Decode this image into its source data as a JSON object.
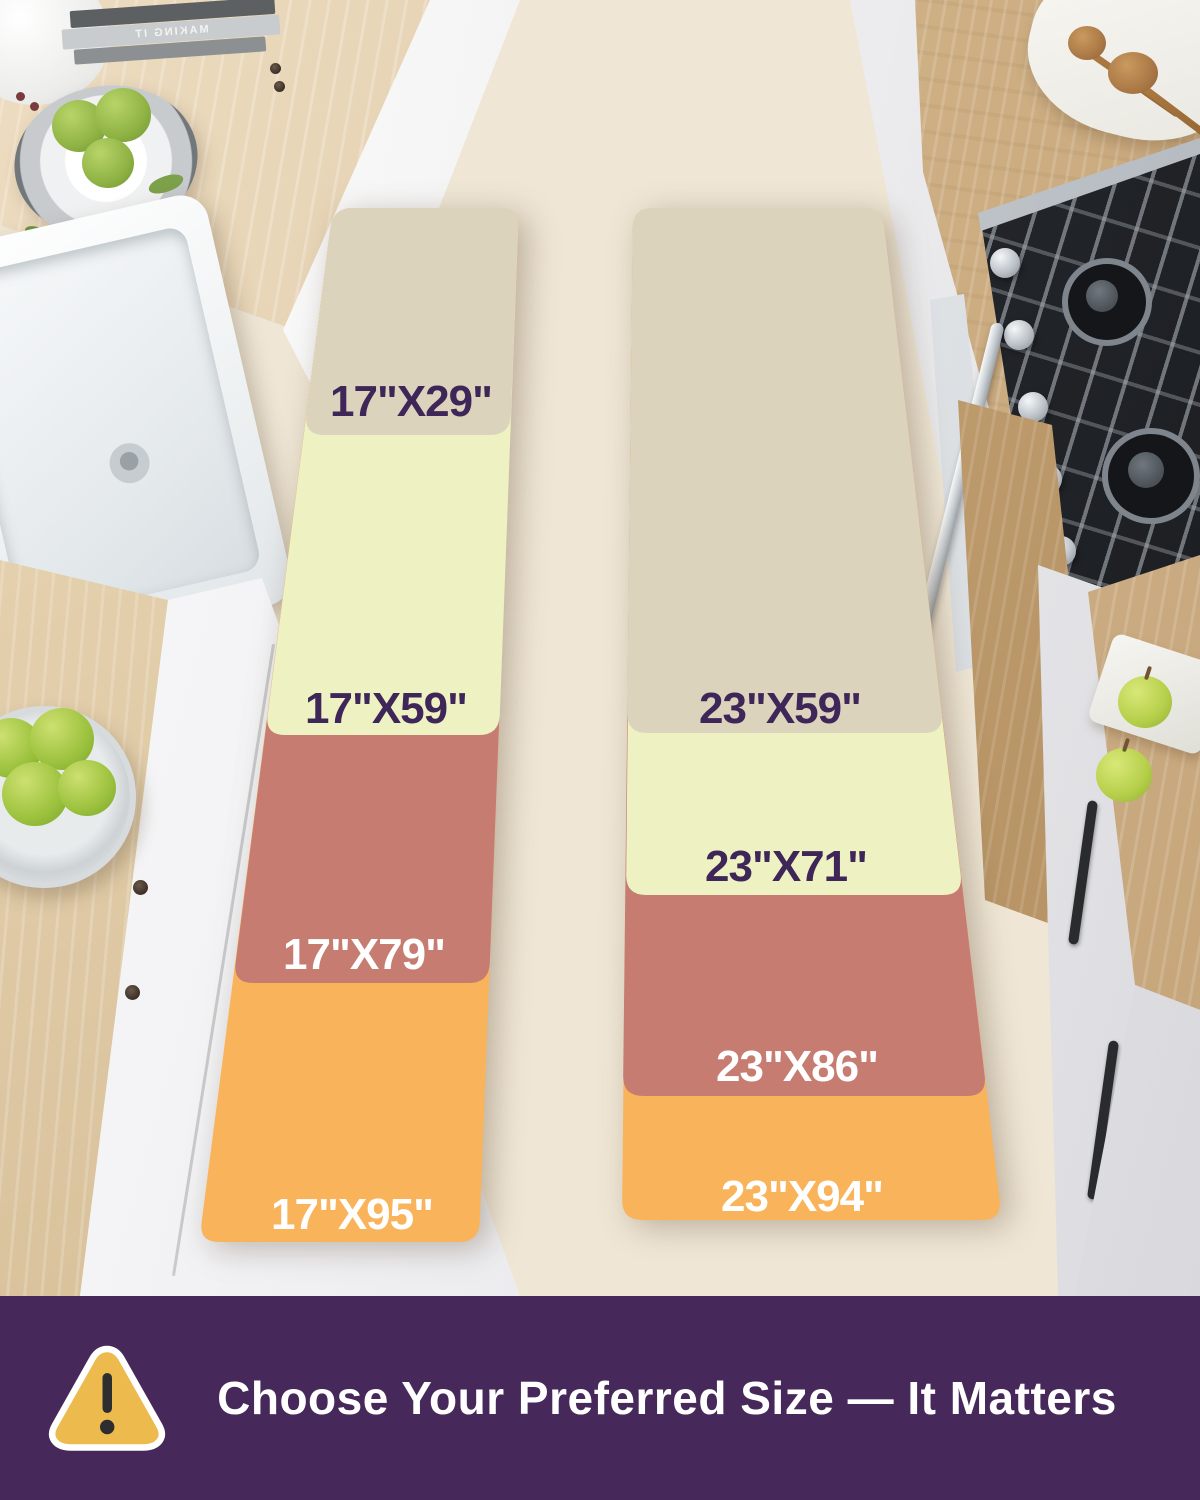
{
  "runners": {
    "left": {
      "name": "17-inch wide runner",
      "sizes": [
        {
          "label": "17\"X29\"",
          "color": "#dcd3bc",
          "label_color": "#3f2659"
        },
        {
          "label": "17\"X59\"",
          "color": "#eef2c3",
          "label_color": "#3f2659"
        },
        {
          "label": "17\"X79\"",
          "color": "#c67c71",
          "label_color": "#ffffff"
        },
        {
          "label": "17\"X95\"",
          "color": "#f9b45b",
          "label_color": "#ffffff"
        }
      ]
    },
    "right": {
      "name": "23-inch wide runner",
      "sizes": [
        {
          "label": "23\"X59\"",
          "color": "#dcd3bc",
          "label_color": "#3f2659"
        },
        {
          "label": "23\"X71\"",
          "color": "#eef2c3",
          "label_color": "#3f2659"
        },
        {
          "label": "23\"X86\"",
          "color": "#c67c71",
          "label_color": "#ffffff"
        },
        {
          "label": "23\"X94\"",
          "color": "#f9b45b",
          "label_color": "#ffffff"
        }
      ]
    }
  },
  "banner": {
    "text": "Choose Your Preferred Size — It Matters",
    "background_color": "#46295a",
    "text_color": "#ffffff",
    "icon": "warning-triangle-icon",
    "icon_color": "#edba4d"
  },
  "scene": {
    "book_spine_text": "MAKING IT"
  }
}
